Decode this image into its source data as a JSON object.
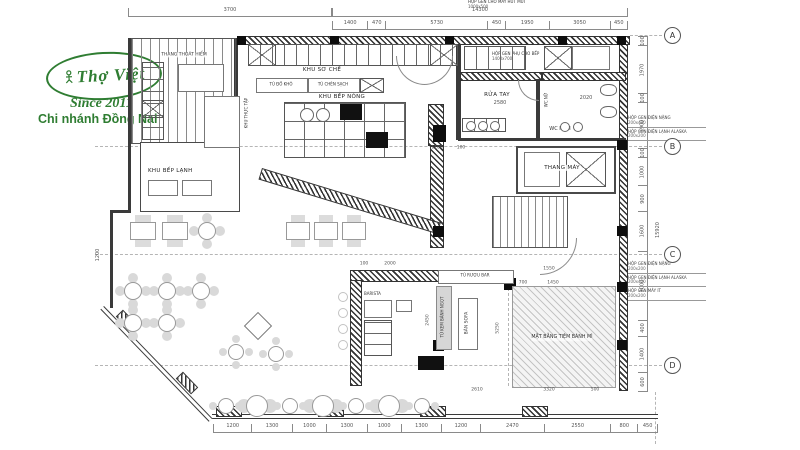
{
  "colors": {
    "logo_green": "#2f7d32",
    "line": "#3a3a3a",
    "dim_text": "#555555"
  },
  "logo": {
    "brand": "Thợ Việt",
    "since": "Since 2011",
    "branch": "Chi nhánh Đồng Nai"
  },
  "grid": [
    "A",
    "B",
    "C",
    "D"
  ],
  "rooms": {
    "thang_thoat_hiem": "THANG THOÁT HIỂM",
    "khu_so_che": "KHU SƠ CHẾ",
    "khu_bep_nong": "KHU BẾP NÓNG",
    "khu_bep_lanh": "KHU BẾP LẠNH",
    "khu_thuc_tap": "KHU THỰC TẬP",
    "tu_do_kho": "TỦ ĐỒ KHÔ",
    "tu_chen_sach": "TỦ CHÉN SẠCH",
    "rua_tay": "RỬA TAY",
    "wc_nu": "WC NỮ",
    "wc_nam": "WC NAM",
    "thang_may": "THANG MÁY",
    "tiem_banh_mi": "MẶT BẰNG TIỆM BÁNH MÌ",
    "barista": "BARISTA",
    "tu_ruou": "TỦ RƯỢU BAR",
    "tu_kem": "TỦ KEM BÁNH NGỌT",
    "ban_sofa": "BÀN SOFA"
  },
  "annotations": {
    "hut_mui_name": "HỘP GEN CHO MÁY HÚT MÙI",
    "hut_mui_size": "1000x500",
    "phu_bep_name": "HỘP GEN PHỤ CHO BẾP",
    "phu_bep_size": "1400x700",
    "b_labels": [
      {
        "name": "HỘP GEN ĐIỆN NẶNG",
        "size": "200x400"
      },
      {
        "name": "HỘP GEN ĐIỆN LẠNH ALASKA",
        "size": "200x200"
      }
    ],
    "c_labels": [
      {
        "name": "HỘP GEN ĐIỆN NẶNG",
        "size": "200x200"
      },
      {
        "name": "HỘP GEN ĐIỆN LẠNH ALASKA",
        "size": "200x400"
      },
      {
        "name": "HỘP GEN MÁY IT",
        "size": "200x200"
      }
    ]
  },
  "dimensions": {
    "top_overall": [
      "3700",
      "14300"
    ],
    "top_segments": [
      "1400",
      "470",
      "5730",
      "450",
      "1950",
      "3050",
      "450"
    ],
    "bottom_segments": [
      "1200",
      "1300",
      "1000",
      "1300",
      "1000",
      "1300",
      "1200",
      "2470",
      "2550",
      "800",
      "450"
    ],
    "right_segments": [
      "100",
      "1970",
      "100",
      "1900",
      "100",
      "1000",
      "900",
      "1600",
      "3000",
      "400",
      "1400",
      "600"
    ],
    "right_overall": "15920",
    "left_side": "1200",
    "diagonal_segments": [
      "1400",
      "2950",
      "1400"
    ],
    "inline": {
      "rua_tay": "2580",
      "wc_nam": "2020",
      "k1100": "1100",
      "k100": "100",
      "bar_2000": "2000",
      "bar_100": "100",
      "t1550": "1550",
      "t1450": "1450",
      "t700": "700",
      "w3320": "3320",
      "w500": "500",
      "b2610": "2610",
      "v5250": "5250",
      "v2450": "2450"
    }
  }
}
